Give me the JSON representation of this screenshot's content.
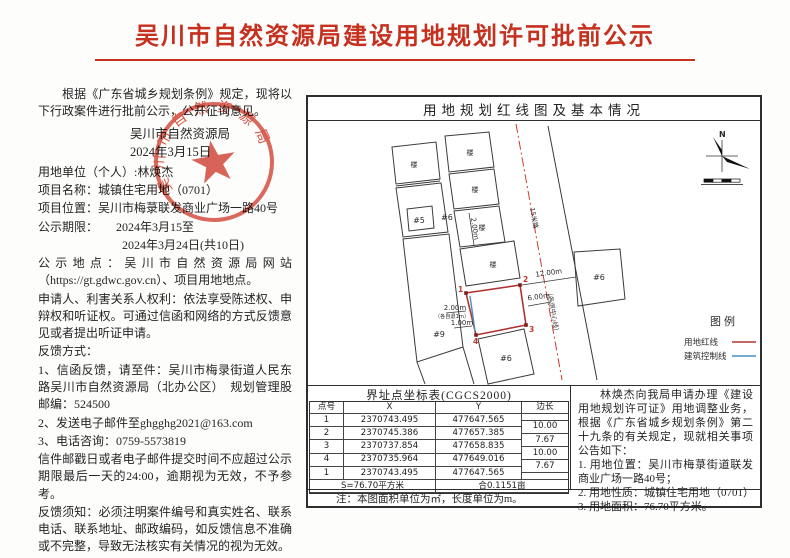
{
  "title": "吴川市自然资源局建设用地规划许可批前公示",
  "colors": {
    "title_red": "#c5301f",
    "seal_red": "#d03a2a",
    "red_line": "#b03434",
    "blue_line": "#4a8fc0"
  },
  "left": {
    "paragraphs": [
      {
        "indent": true,
        "text": "根据《广东省城乡规划条例》规定，现将以下行政案件进行批前公示，公开征询意见。"
      }
    ],
    "issuer": "吴川市自然资源局",
    "issue_date": "2024年3月15日",
    "body_paragraphs": [
      {
        "indent": false,
        "text": "用地单位（个人）:林焕杰"
      },
      {
        "indent": false,
        "text": "项目名称：城镇住宅用地（0701）"
      },
      {
        "indent": false,
        "text": "项目位置：吴川市梅菉联发商业广场一路40号"
      },
      {
        "indent": false,
        "text": "公示期限：　　2024年3月15至"
      },
      {
        "indent": false,
        "text": "　　　　　　　2024年3月24日(共10日)"
      },
      {
        "indent": false,
        "text": "公示地点：吴川市自然资源局网站（https://gt.gdwc.gov.cn）、项目用地地点。"
      },
      {
        "indent": false,
        "text": "申请人、利害关系人权利：依法享受陈述权、申辩权和听证权。可通过信函和网络的方式反馈意见或者提出听证申请。"
      },
      {
        "indent": false,
        "text": "反馈方式："
      },
      {
        "indent": false,
        "text": "1、信函反馈，请至件：吴川市梅录街道人民东路吴川市自然资源局（北办公区）　规划管理股　邮编：524500"
      },
      {
        "indent": false,
        "text": "2、发送电子邮件至ghgghg2021@163.com"
      },
      {
        "indent": false,
        "text": "3、电话咨询：0759-5573819"
      },
      {
        "indent": false,
        "text": "信件邮戳日或者电子邮件提交时间不应超过公示期限最后一天的24:00，逾期视为无效，不予参考。"
      },
      {
        "indent": false,
        "text": "反馈须知：必须注明案件编号和真实姓名、联系电话、联系地址、邮政编码，如反馈信息不准确或不完整，导致无法核实有关情况的视为无效。"
      }
    ]
  },
  "seal": {
    "arc_text": "吴川市自然资源局"
  },
  "panel": {
    "header": "用地规划红线图及基本情况",
    "map": {
      "north_label": "N",
      "building_glyph": "楼",
      "plots": {
        "p5": "#5",
        "p6a": "#6",
        "p9": "#9",
        "p6b": "#6",
        "p6c": "#6"
      },
      "dims": {
        "d12": "12.00m",
        "d6": "6.00m",
        "d2": "2.00m",
        "d2_note": "（各自退1m）",
        "d1": "1.00m",
        "d2v": "2.00m"
      },
      "road_text_1": "15米路",
      "road_text_2": "（各退中心线）",
      "corners": [
        "1",
        "2",
        "3",
        "4"
      ]
    },
    "legend": {
      "title": "图例",
      "items": [
        {
          "label": "用地红线",
          "color": "#b03434"
        },
        {
          "label": "建筑控制线",
          "color": "#4a8fc0"
        }
      ]
    },
    "coord_table": {
      "title": "界址点坐标表(CGCS2000)",
      "columns": [
        "点号",
        "X",
        "Y",
        "边长"
      ],
      "rows": [
        [
          "1",
          "2370743.495",
          "477647.565"
        ],
        [
          "2",
          "2370745.386",
          "477657.385"
        ],
        [
          "3",
          "2370737.854",
          "477658.835"
        ],
        [
          "4",
          "2370735.964",
          "477649.016"
        ],
        [
          "1",
          "2370743.495",
          "477647.565"
        ]
      ],
      "side_lengths": [
        "10.00",
        "7.67",
        "10.00",
        "7.67"
      ],
      "footer_area": "S=76.70平方米",
      "footer_mu": "合0.1151亩"
    },
    "announcement": [
      {
        "indent": true,
        "text": "林焕杰向我局申请办理《建设用地规划许可证》用地调整业务，根据《广东省城乡规划条例》第二十九条的有关规定，现就相关事项公告如下："
      },
      {
        "indent": false,
        "text": "1. 用地位置：吴川市梅菉街道联发商业广场一路40号；"
      },
      {
        "indent": false,
        "text": "2. 用地性质：城镇住宅用地（0701）"
      },
      {
        "indent": false,
        "text": "3. 用地面积：76.70平方米。"
      }
    ],
    "note": "注：本图面积单位为㎡，长度单位为m。"
  }
}
